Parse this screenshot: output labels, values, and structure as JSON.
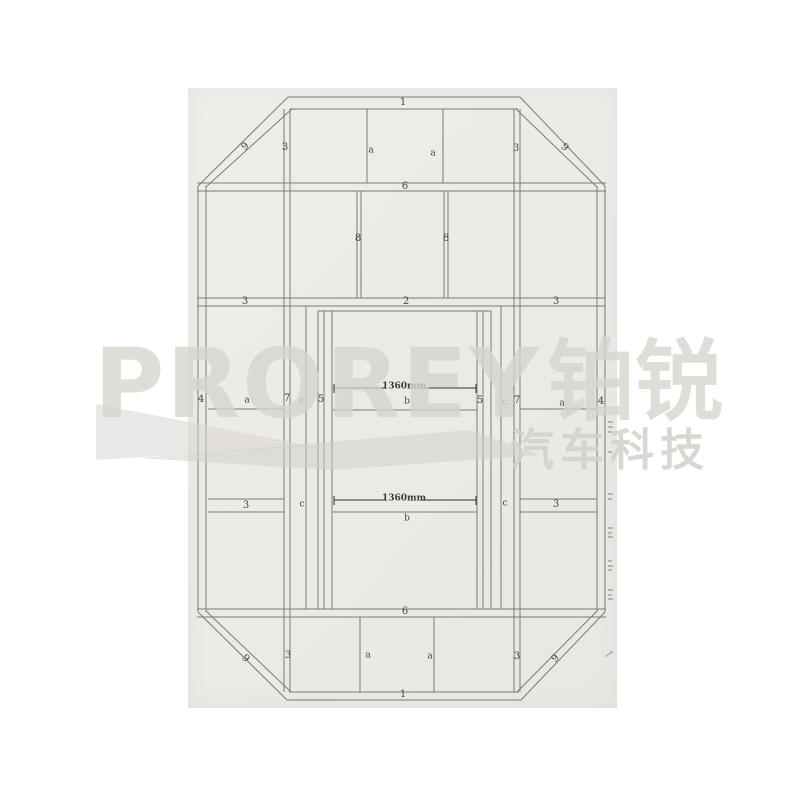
{
  "colors": {
    "paper": "#eceae6",
    "line": "#7b7a74",
    "dimension_line": "#55544e",
    "label_text": "#45443e",
    "watermark": "#d6d4ce"
  },
  "watermark": {
    "brand": "PROREY",
    "brand_cjk": "铂锐",
    "tagline": "汽车科技"
  },
  "diagram": {
    "type": "frame-assembly-drawing",
    "dimension": "1360mm",
    "labels": {
      "one": "1",
      "two": "2",
      "three": "3",
      "four": "4",
      "five": "5",
      "six": "6",
      "seven": "7",
      "eight": "8",
      "nine": "9",
      "a": "a",
      "b": "b",
      "c": "c"
    },
    "annotations": {
      "margin_arrow": "↗"
    }
  }
}
